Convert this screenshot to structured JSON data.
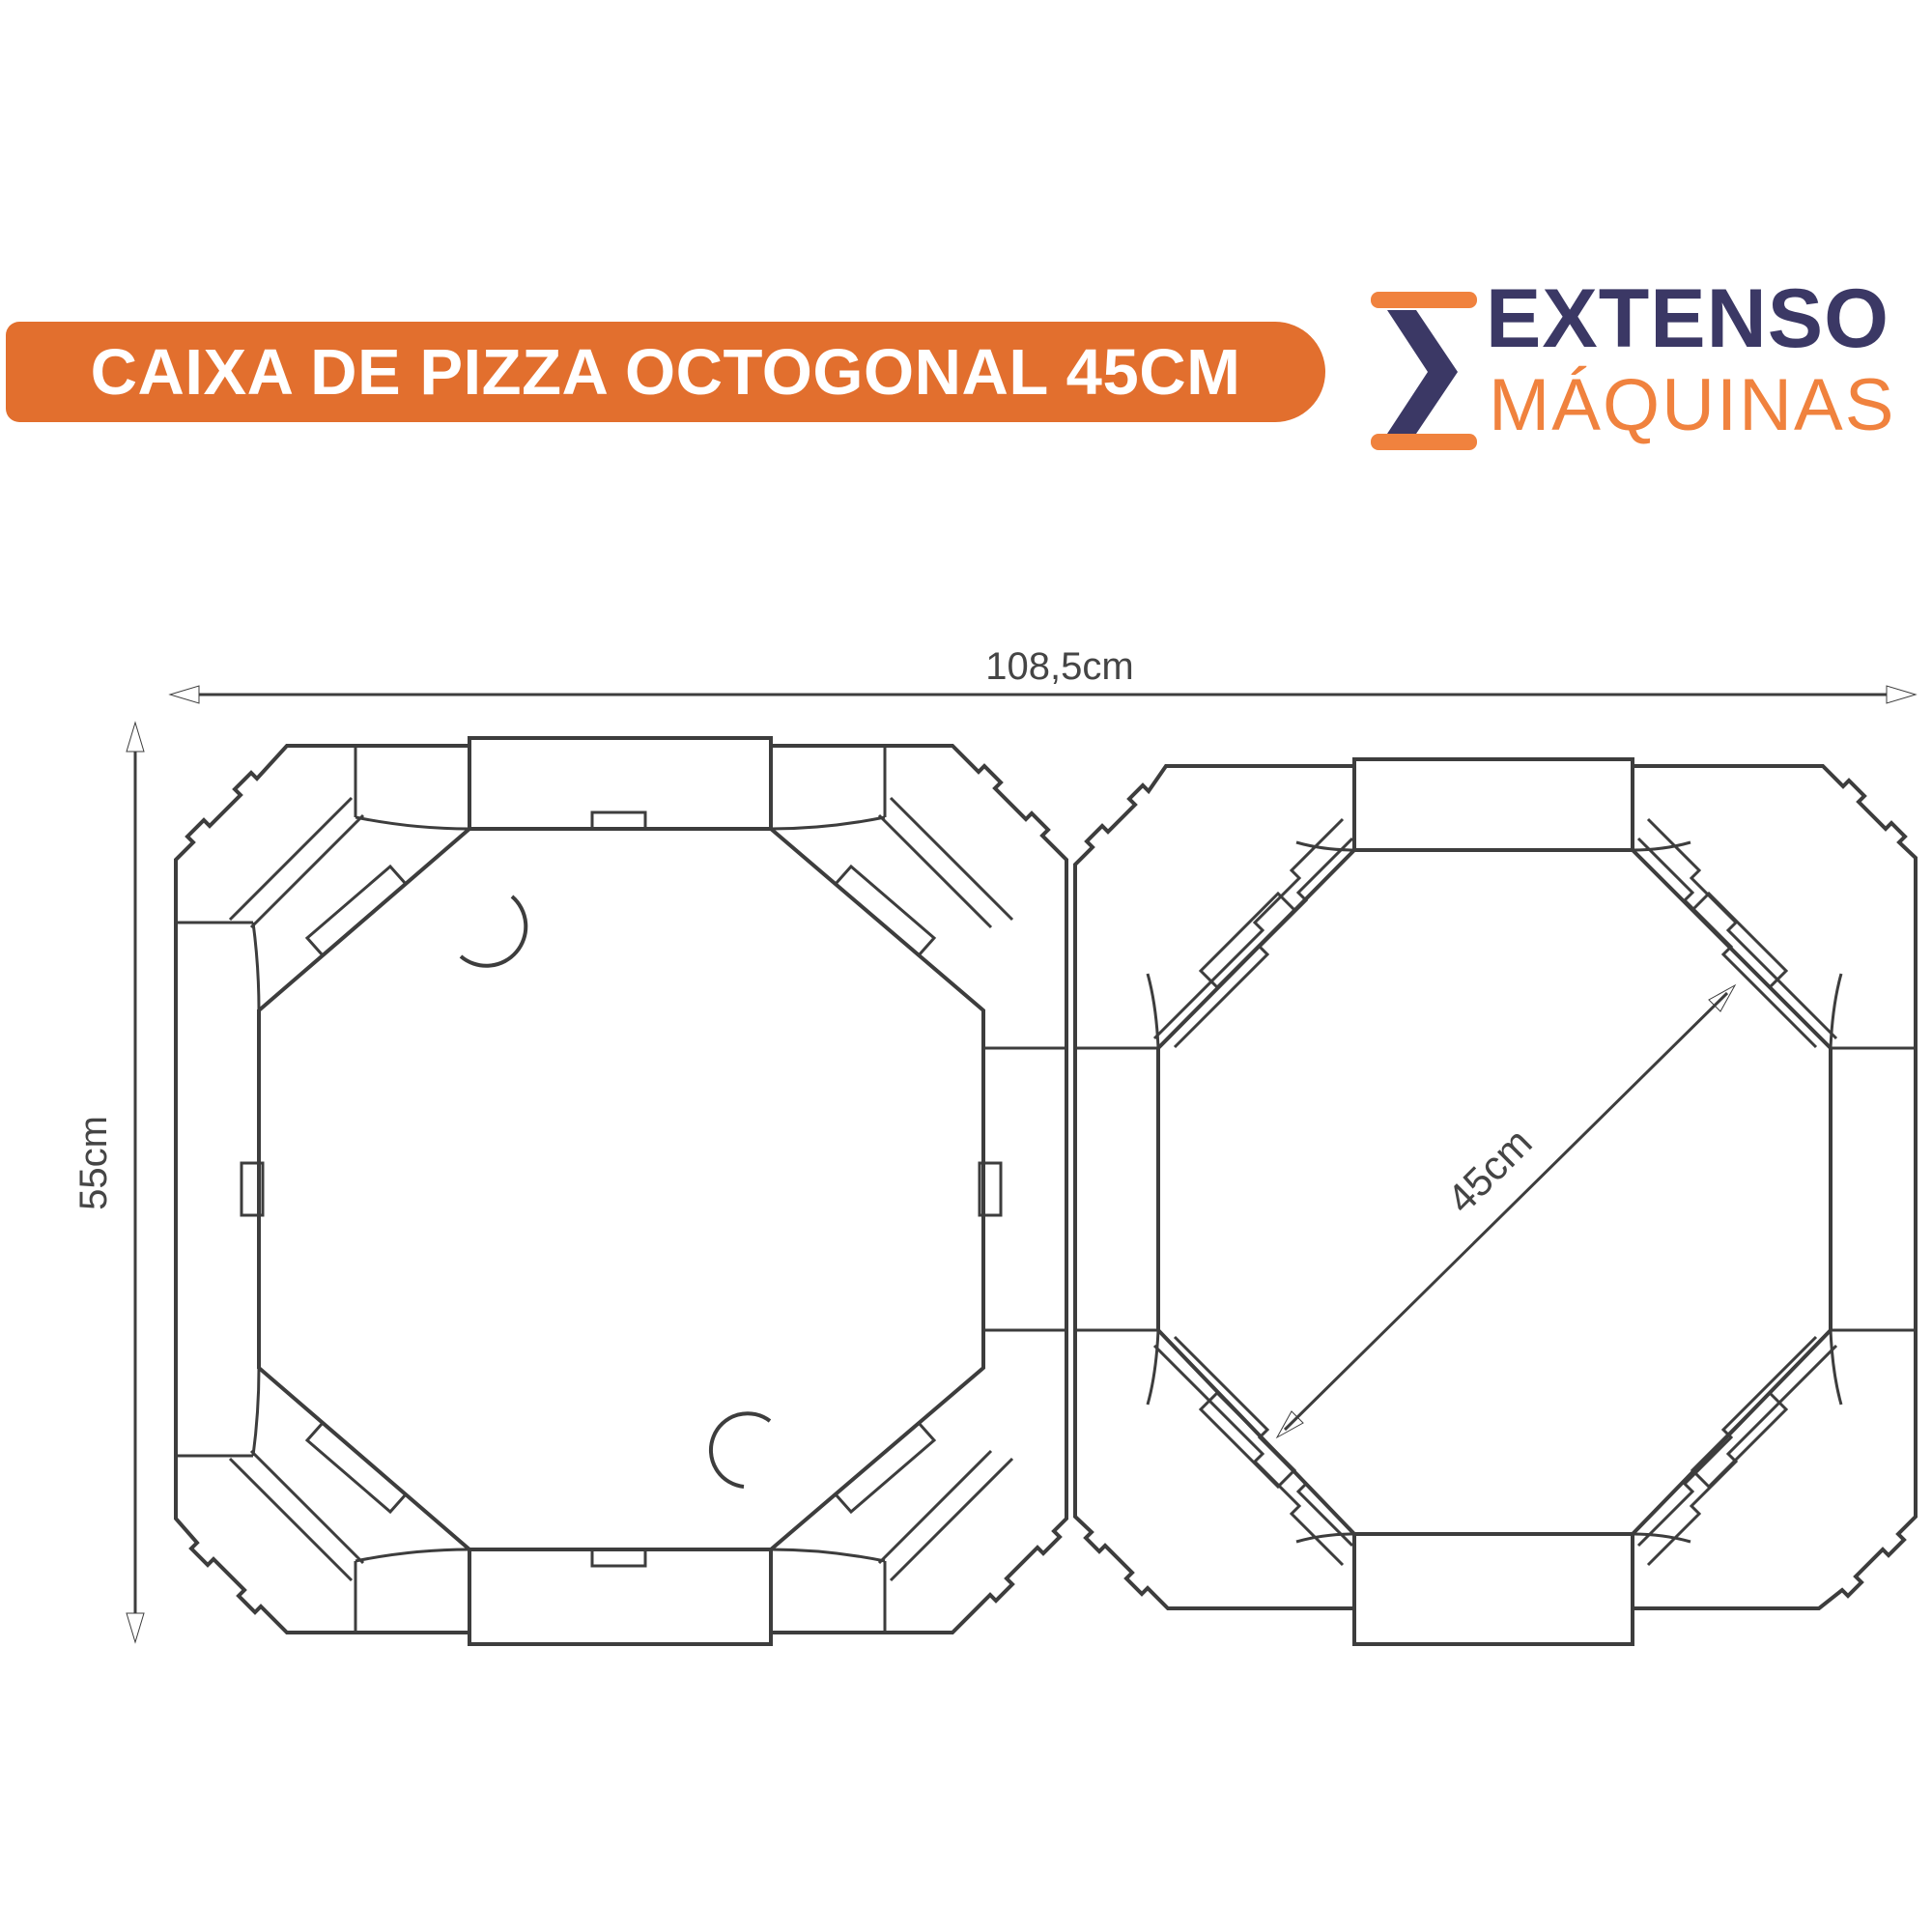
{
  "banner": {
    "title": "CAIXA DE PIZZA OCTOGONAL 45CM",
    "bg_color": "#e26f2e",
    "text_color": "#ffffff"
  },
  "logo": {
    "word1": "EXTENSO",
    "word2": "MÁQUINAS",
    "navy_color": "#3b3865",
    "orange_color": "#f0823e",
    "icon": "sigma-icon"
  },
  "diagram": {
    "type": "die-cut technical drawing",
    "subject": "octagonal pizza box blank, lid panel and base panel side by side",
    "dimensions": {
      "width_label": "108,5cm",
      "height_label": "55cm",
      "diagonal_label": "45cm"
    },
    "panels": [
      {
        "name": "lid-panel",
        "features": "octagonal panel, four corner flaps with tabs, two crescent thumb cuts, edge flaps with locking tabs"
      },
      {
        "name": "base-panel",
        "features": "octagonal panel, four corner flaps with tabs, stepped corner walls, diagonal 45cm dimension"
      }
    ],
    "line_color": "#3d3d3d",
    "dim_color": "#4a4a4a"
  }
}
